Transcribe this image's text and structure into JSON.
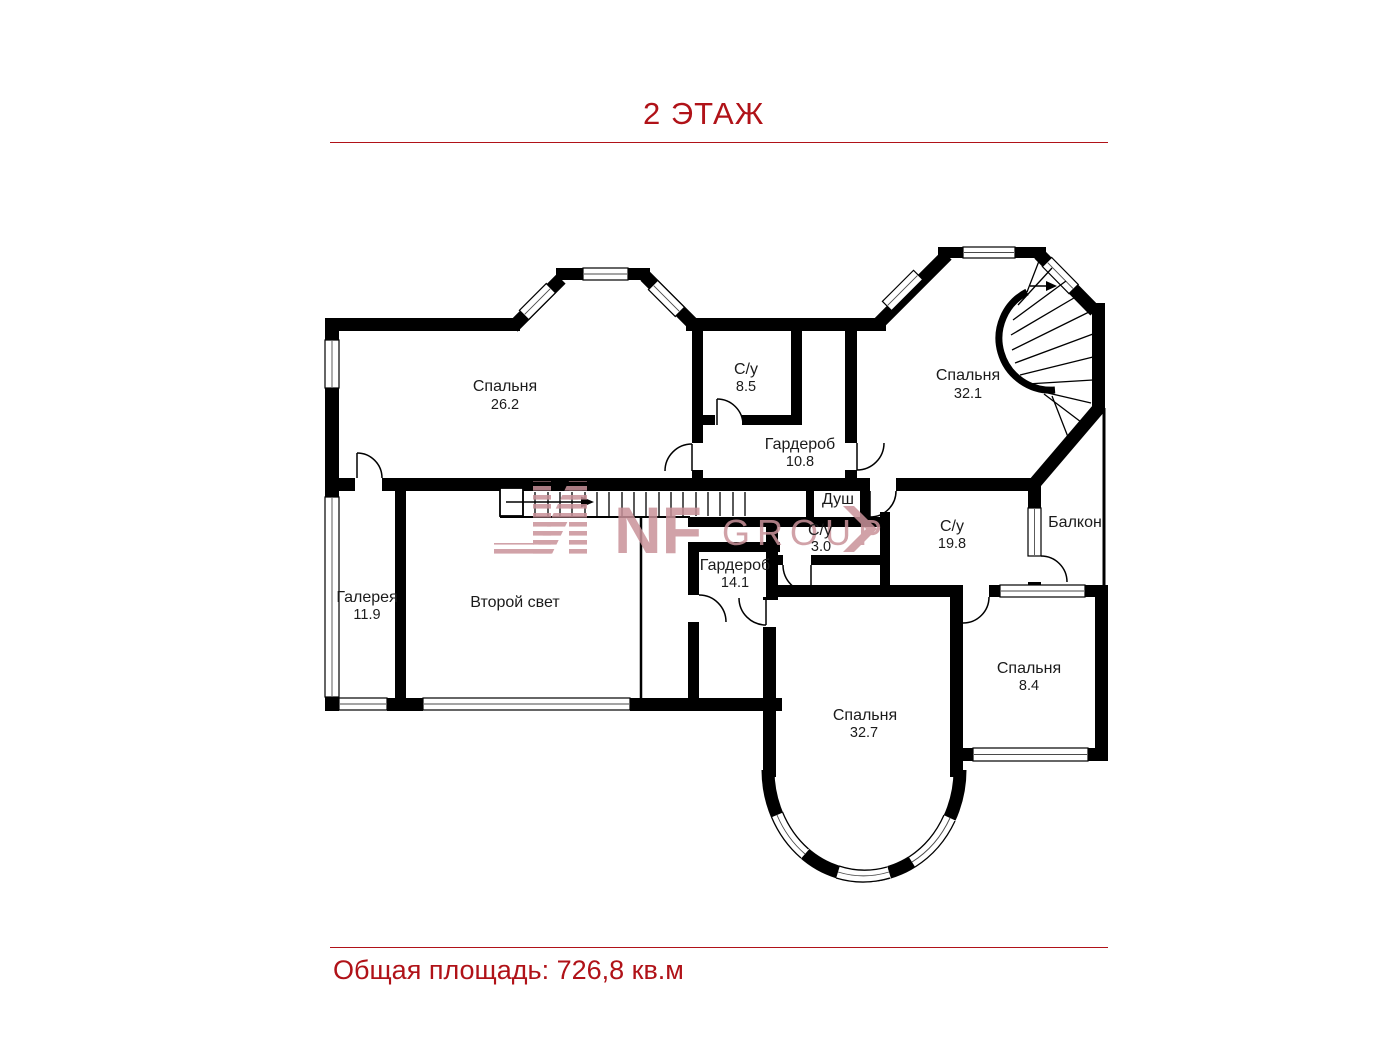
{
  "header": {
    "title": "2 ЭТАЖ"
  },
  "footer": {
    "total_area": "Общая площадь: 726,8 кв.м"
  },
  "watermark": {
    "letters": "NF",
    "word": "GROUP"
  },
  "colors": {
    "accent": "#b01218",
    "walls": "#000000",
    "watermark": "#c9929a",
    "labels": "#1b1b1b"
  },
  "plan": {
    "floor_label": "2 ЭТАЖ",
    "rooms": [
      {
        "id": "bedroom-1",
        "name": "Спальня",
        "area": "26.2"
      },
      {
        "id": "bathroom-1",
        "name": "С/у",
        "area": "8.5"
      },
      {
        "id": "wardrobe-1",
        "name": "Гардероб",
        "area": "10.8"
      },
      {
        "id": "bedroom-2",
        "name": "Спальня",
        "area": "32.1"
      },
      {
        "id": "shower",
        "name": "Душ",
        "area": ""
      },
      {
        "id": "bathroom-2",
        "name": "С/у",
        "area": "3.0"
      },
      {
        "id": "bathroom-3",
        "name": "С/у",
        "area": "19.8"
      },
      {
        "id": "balcony",
        "name": "Балкон",
        "area": ""
      },
      {
        "id": "gallery",
        "name": "Галерея",
        "area": "11.9"
      },
      {
        "id": "void",
        "name": "Второй свет",
        "area": ""
      },
      {
        "id": "wardrobe-2",
        "name": "Гардероб",
        "area": "14.1"
      },
      {
        "id": "bedroom-3",
        "name": "Спальня",
        "area": "32.7"
      },
      {
        "id": "bedroom-4",
        "name": "Спальня",
        "area": "8.4"
      }
    ]
  }
}
